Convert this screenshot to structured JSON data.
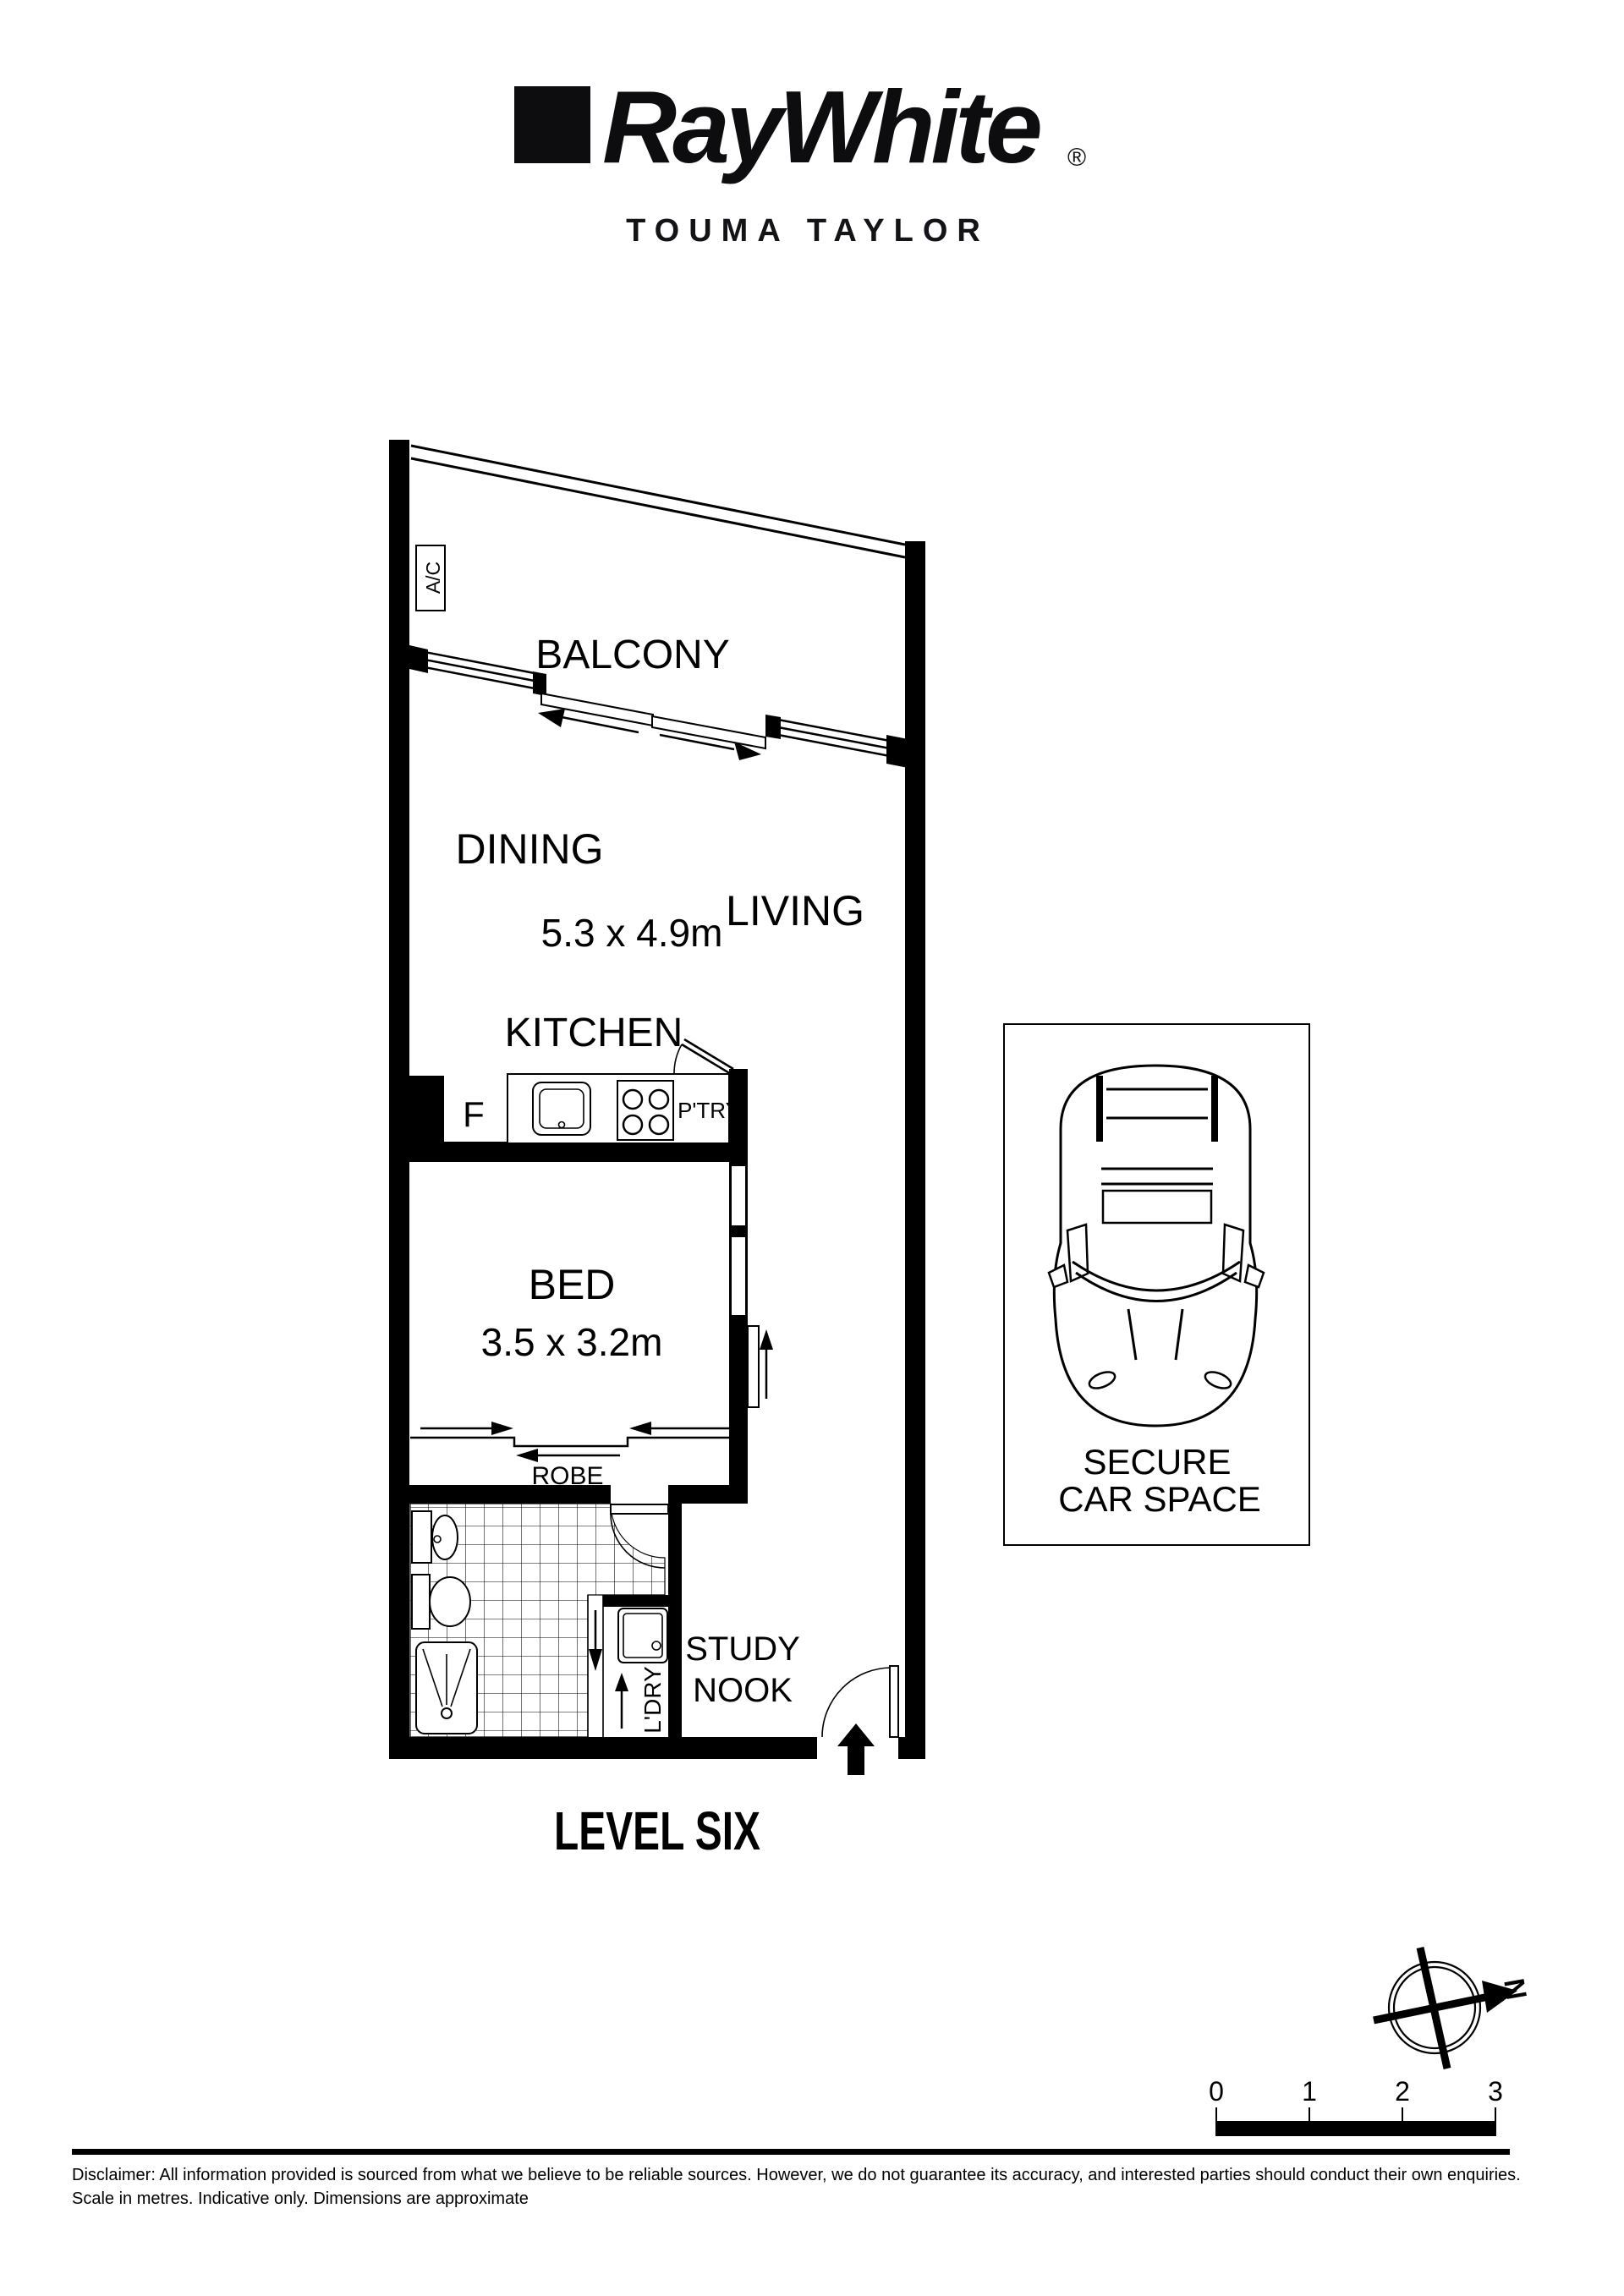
{
  "header": {
    "brand": "RayWhite",
    "registered_mark": "®",
    "agency": "TOUMA TAYLOR"
  },
  "plan": {
    "labels": {
      "ac": "A/C",
      "balcony": "BALCONY",
      "dining": "DINING",
      "living": "LIVING",
      "living_dims": "5.3 x 4.9m",
      "kitchen": "KITCHEN",
      "fridge": "F",
      "pantry": "P'TRY",
      "bed": "BED",
      "bed_dims": "3.5 x 3.2m",
      "robe": "ROBE",
      "laundry": "L'DRY",
      "study_line1": "STUDY",
      "study_line2": "NOOK"
    },
    "level_label": "LEVEL SIX"
  },
  "car_space": {
    "line1": "SECURE",
    "line2": "CAR SPACE"
  },
  "compass": {
    "north_label": "N"
  },
  "scale_bar": {
    "ticks": [
      "0",
      "1",
      "2",
      "3"
    ]
  },
  "footer": {
    "disclaimer_line1": "Disclaimer: All information provided is sourced from what we believe to be reliable sources. However, we do not guarantee  its accuracy, and interested parties should conduct their own enquiries.",
    "disclaimer_line2": "Scale in metres. Indicative only. Dimensions are approximate"
  },
  "colors": {
    "ink": "#000000",
    "paper": "#ffffff"
  }
}
